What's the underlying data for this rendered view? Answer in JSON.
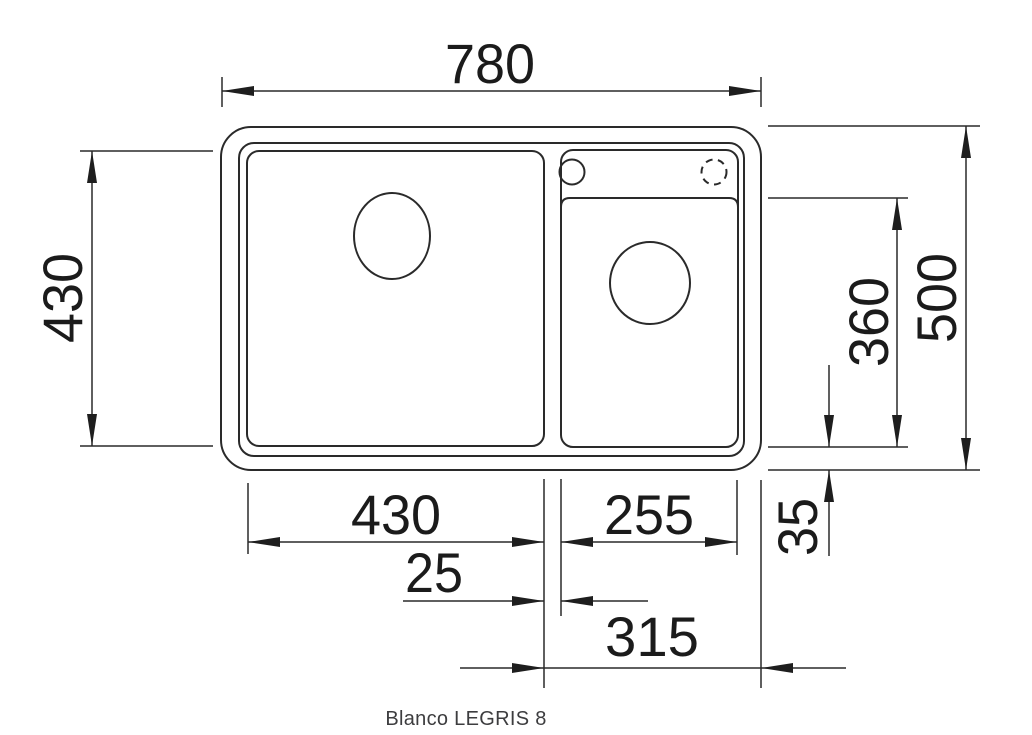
{
  "product": {
    "caption": "Blanco LEGRIS 8"
  },
  "dimensions": {
    "overall_width": "780",
    "overall_depth": "500",
    "left_bowl_width": "430",
    "left_bowl_depth": "430",
    "right_bowl_width": "255",
    "right_bowl_depth": "360",
    "divider_width": "25",
    "right_section_width": "315",
    "rear_edge_offset": "35"
  },
  "features": {
    "left_drain": "drain-hole",
    "right_drain": "drain-hole",
    "tap_hole": "tap-hole",
    "optional_tap_hole": "optional-tap-hole-dashed"
  },
  "colors": {
    "line": "#2a2a2a",
    "dimension_text": "#1b1b1b",
    "caption_text": "#3d3d3f",
    "background": "#ffffff"
  }
}
